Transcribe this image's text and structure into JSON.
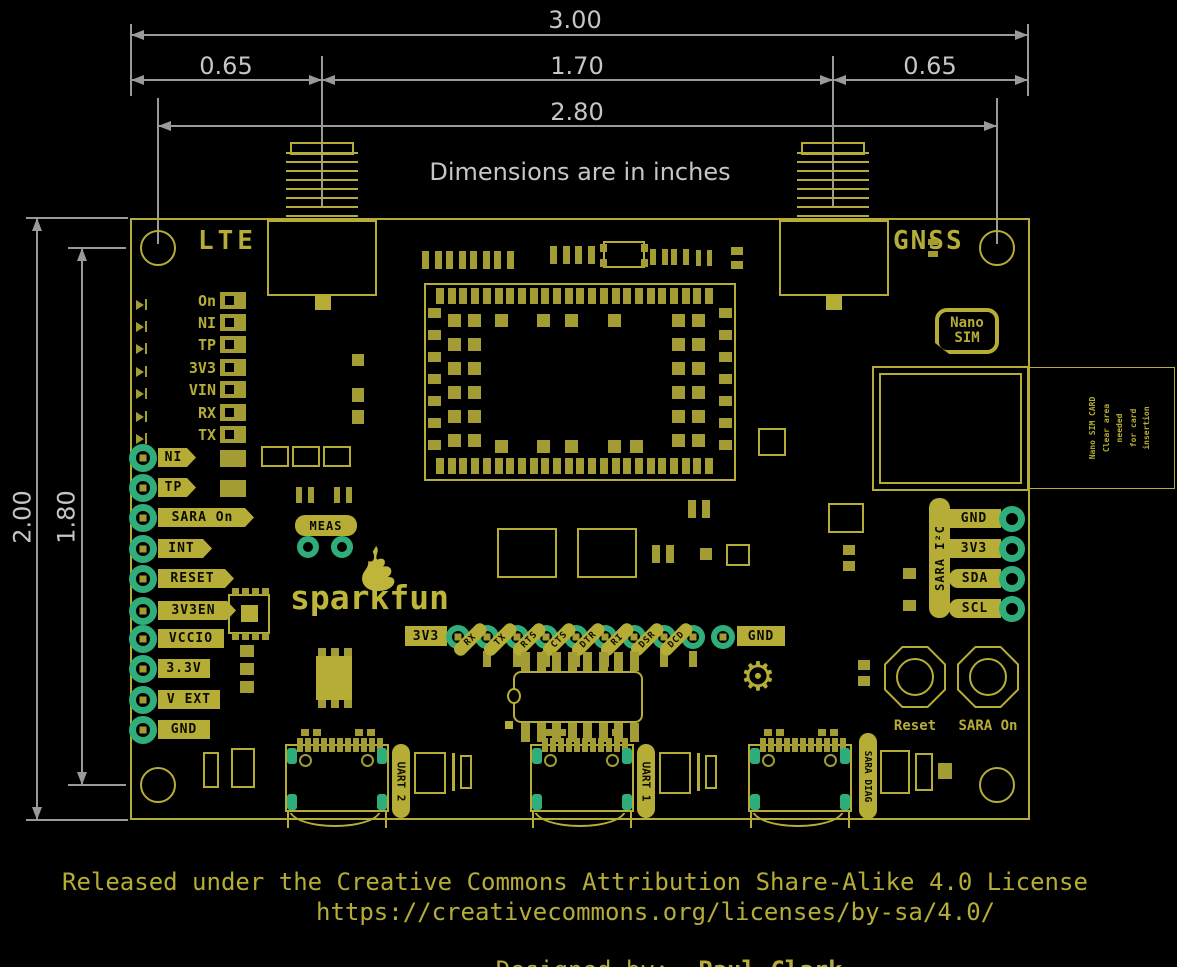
{
  "colors": {
    "silk_yellow": "#b6ad37",
    "pad_olive": "#a39b33",
    "plated_teal": "#2fae7c",
    "dimension_gray": "#9a9a9a",
    "dim_text_gray": "#c6c6c6",
    "background": "#000000"
  },
  "dimensions": {
    "width_total": "3.00",
    "left_offset": "0.65",
    "antenna_span": "1.70",
    "right_offset": "0.65",
    "hole_span": "2.80",
    "height_total": "2.00",
    "hole_height_span": "1.80",
    "note": "Dimensions are in inches"
  },
  "board": {
    "lte_label": "LTE",
    "gnss_label": "GNSS",
    "led_rows": [
      "On",
      "NI",
      "TP",
      "3V3",
      "VIN",
      "RX",
      "TX"
    ],
    "left_pads": [
      "NI",
      "TP",
      "SARA On",
      "INT",
      "RESET",
      "3V3EN",
      "VCCIO",
      "3.3V",
      "V EXT",
      "GND"
    ],
    "meas_label": "MEAS",
    "logo_text": "sparkfun",
    "gear_icon": "⚙",
    "bottom_header": {
      "left_label": "3V3",
      "right_label": "GND",
      "signals": [
        "RX",
        "TX",
        "RTS",
        "CTS",
        "DTR",
        "RI",
        "DSR",
        "DCD"
      ]
    },
    "i2c": {
      "label": "SARA I²C",
      "pads": [
        "GND",
        "3V3",
        "SDA",
        "SCL"
      ]
    },
    "nano_sim": {
      "line1": "Nano",
      "line2": "SIM"
    },
    "sim_note": [
      "Nano SIM CARD",
      "Clear area needed",
      "for card insertion"
    ],
    "buttons": {
      "reset": "Reset",
      "sara_on": "SARA On"
    },
    "usb_labels": [
      "UART 2",
      "UART 1",
      "SARA DIAG"
    ]
  },
  "footer": {
    "line1": "Released under the Creative Commons Attribution Share-Alike 4.0 License",
    "line2": "https://creativecommons.org/licenses/by-sa/4.0/",
    "designed_prefix": "Designed by:  ",
    "designed_name": "Paul Clark"
  }
}
